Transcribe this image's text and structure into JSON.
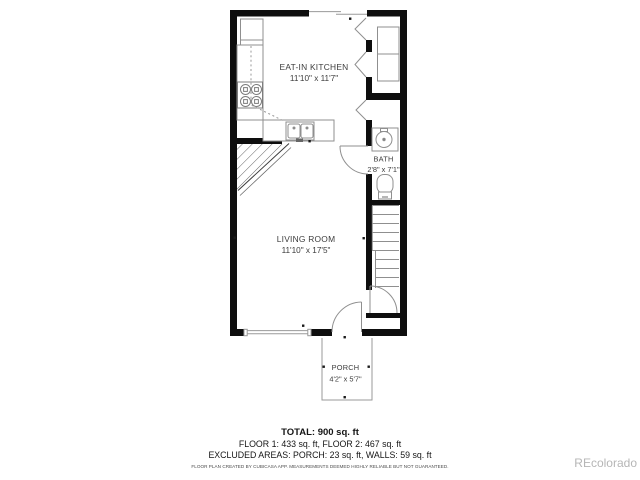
{
  "plan": {
    "rooms": [
      {
        "label": "EAT-IN KITCHEN",
        "dims": "11'10\" x 11'7\""
      },
      {
        "label": "LIVING ROOM",
        "dims": "11'10\" x 17'5\""
      },
      {
        "label": "BATH",
        "dims": "2'8\" x 7'1\""
      },
      {
        "label": "PORCH",
        "dims": "4'2\" x 5'7\""
      }
    ],
    "fixtures": [
      "refrigerator-icon",
      "stove-icon",
      "kitchen-sink-icon",
      "counter-icon",
      "bathroom-sink-icon",
      "toilet-icon",
      "closet-shelves-icon",
      "stairs-icon",
      "bifold-door-icon",
      "door-swing-icon",
      "window-icon",
      "sliding-door-icon",
      "overhead-stair-hatch-icon"
    ]
  },
  "summary": {
    "total": "TOTAL: 900 sq. ft",
    "floors": "FLOOR 1: 433 sq. ft, FLOOR 2: 467 sq. ft",
    "excluded": "EXCLUDED AREAS: PORCH: 23 sq. ft, WALLS: 59 sq. ft",
    "disclaimer": "FLOOR PLAN CREATED BY CUBICASA APP. MEASUREMENTS DEEMED HIGHLY RELIABLE BUT NOT GUARANTEED."
  },
  "watermark": "REcolorado",
  "colors": {
    "wall": "#0e0e0e",
    "fixture_line": "#8f8f8f",
    "label_text": "#3c3c3c",
    "watermark_text": "#b6b6b6"
  }
}
